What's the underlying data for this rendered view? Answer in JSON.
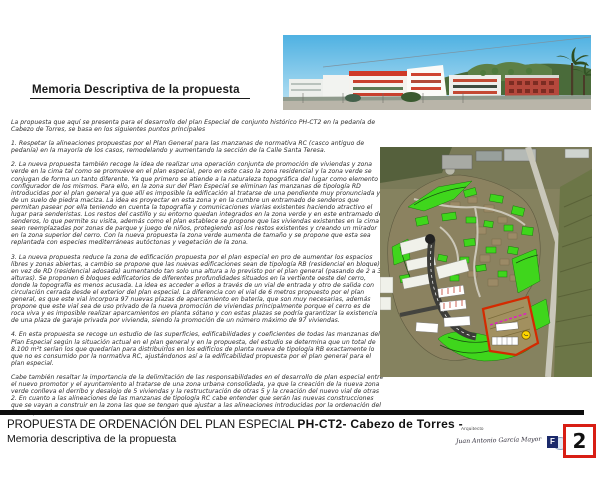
{
  "page": {
    "heading": "Memoria Descriptiva de la propuesta",
    "body": {
      "paragraphs": [
        "La propuesta que aquí se presenta para el desarrollo del plan Especial de conjunto histórico PH-CT2 en la pedanía de Cabezo de Torres, se basa en los siguientes puntos principales",
        "1. Respetar la alineaciones propuestas por el Plan General para las manzanas de normativa RC (casco antiguo de pedanía) en la mayoría de los casos, remodelando y aumentando la sección de la Calle Santa Teresa.",
        "2. La nueva propuesta también recoge la idea de realizar una operación conjunta de promoción de viviendas y zona verde en la cima tal como se promueve en el plan especial, pero en este caso la zona residencial y la zona verde se conjugan de forma un tanto diferente. Ya que primero se atiende a la naturaleza topográfica del lugar como elemento configurador de los mismos. Para ello, en la zona sur del Plan Especial se eliminan las manzanas de tipología RD introducidas por el plan general ya que allí es imposible la edificación al tratarse de una pendiente muy pronunciada y de un suelo de piedra maciza. La idea es proyectar en esta zona y en la cumbre un entramado de senderos que permitan pasear por ella teniendo en cuenta la topografía y comunicaciones viarias existentes haciendo atractivo el lugar para senderistas. Los restos del castillo y su entorno quedan integrados en la zona verde y en este entramado de senderos, lo que permite su visita, además como el plan establece se propone que las viviendas existentes en la cima sean reemplazadas por zonas de parque y juego de niños, protegiendo así los restos existentes y creando un mirador en la zona superior del cerro. Con la nueva propuesta la zona verde aumenta de tamaño y se propone que esta sea replantada con especies mediterráneas autóctonas y vegetación de la zona.",
        "3. La nueva propuesta reduce la zona de edificación propuesta por el plan especial en pro de aumentar los espacios libres y zonas abiertas, a cambio se propone que las nuevas edificaciones sean de tipología RB (residencial en bloque) en vez de RD (residencial adosada) aumentando tan solo una altura a lo previsto por el plan general (pasando de 2 a 3 alturas). Se proponen 6 bloques edificatorios de diferentes profundidades situados en la vertiente oeste del cerro, donde la topografía es menos acusada. La idea es acceder a ellos a través de un vial de entrada y otro de salida con circulación cerrada desde el exterior del plan especial. La diferencia con el vial de 6 metros propuesto por el plan general, es que este vial incorpora 97 nuevas plazas de aparcamiento en batería, que son muy necesarias, además propone que este vial sea de uso privado de la nueva promoción de viviendas principalmente porque el cerro es de roca viva y es imposible realizar aparcamientos en planta sótano y con estas plazas se podría garantizar la existencia de una plaza de garaje privada por vivienda, siendo la promoción de un número máximo de 97 viviendas.",
        "4. En esta propuesta se recoge un estudio de las superficies, edificabilidades y coeficientes de todas las manzanas del Plan Especial según la situación actual en el plan general y en la propuesta, del estudio se determina que un total de 8.100 m²t serían los que quedarían para distribuirlos en los edificios de planta nueva de tipología RB exactamente lo que no es consumido por la normativa RC, ajustándonos así a la edificabilidad propuesta por el plan general para el plan especial.",
        "Cabe también resaltar la importancia de la delimitación de las responsabilidades en el desarrollo de plan especial entre el nuevo promotor y el ayuntamiento al tratarse de una zona urbana consolidada, ya que la creación de la nueva zona verde conlleva el derribo y desalojo de 5 viviendas y la restructuración de otras 5 y la creación del nuevo vial de otras 2. En cuanto a las alineaciones de las manzanas de tipología RC cabe entender que serán las nuevas construcciones que se vayan a construir en la zona las que se tengan que ajustar a las alineaciones introducidas por la ordenación del Plan Especial."
      ]
    },
    "footer": {
      "title_main": "PROPUESTA DE ORDENACIÓN DEL PLAN ESPECIAL",
      "title_code": "PH-CT2- Cabezo de Torres -",
      "subtitle": "Memoria descriptiva de la propuesta",
      "architect_label": "Arquitecto",
      "signature": "Juan Antonio García Mayor",
      "logo_letter": "F",
      "page_number": "2"
    },
    "colors": {
      "accent_red": "#d81e14",
      "overlay_green": "#3fd61c",
      "sky_blue": "#5fb9e4",
      "logo_navy": "#1b2a6b"
    }
  }
}
